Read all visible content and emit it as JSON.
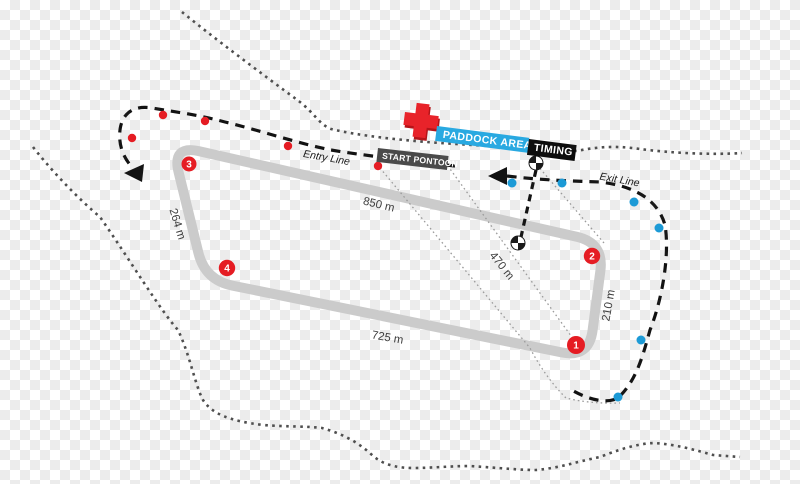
{
  "map": {
    "paddock_label": "PADDOCK AREA",
    "timing_label": "TIMING",
    "start_pontoon_label": "START PONTOON",
    "entry_line_label": "Entry Line",
    "exit_line_label": "Exit Line"
  },
  "distances": {
    "top_straight": "850 m",
    "bottom_straight": "725 m",
    "left_side": "264 m",
    "start_diagonal": "470 m",
    "right_side": "210 m"
  },
  "turns": [
    {
      "number": "1"
    },
    {
      "number": "2"
    },
    {
      "number": "3"
    },
    {
      "number": "4"
    }
  ],
  "buoys": {
    "entry_red": [
      [
        163,
        115
      ],
      [
        205,
        121
      ],
      [
        288,
        146
      ],
      [
        378,
        166
      ],
      [
        132,
        138
      ]
    ],
    "exit_blue": [
      [
        512,
        183
      ],
      [
        562,
        183
      ],
      [
        634,
        202
      ],
      [
        659,
        228
      ],
      [
        641,
        340
      ],
      [
        618,
        397
      ]
    ]
  },
  "icons": {
    "first_aid": "first-aid-cross",
    "start_marker": "start-position-marker",
    "entry_arrow": "arrow-left",
    "exit_arrow": "arrow-left"
  },
  "colors": {
    "paddock_blue": "#29a9e1",
    "timing_black": "#0d0d0d",
    "pontoon_gray": "#4a4a4a",
    "track_gray": "#cbcbcb",
    "buoy_red": "#e51c23",
    "buoy_blue": "#1c9ad6",
    "cross_red": "#e8232a",
    "cross_shadow": "#b41419",
    "dash_black": "#141414",
    "shore_gray": "#4f4f4f",
    "thin_dot_gray": "#9b9b9b"
  }
}
